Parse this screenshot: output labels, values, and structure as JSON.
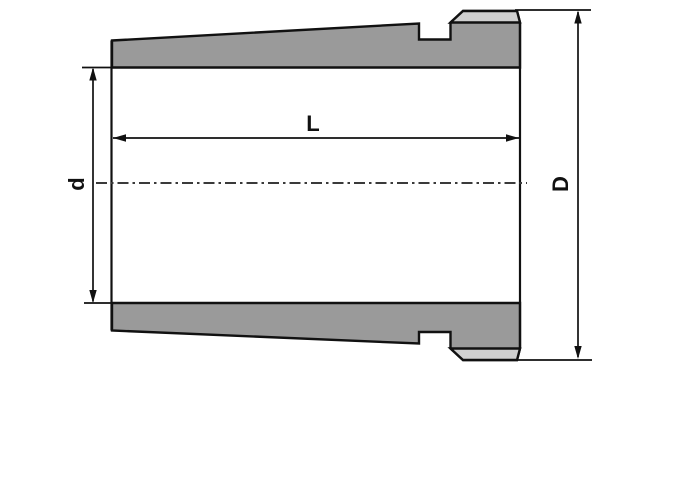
{
  "drawing": {
    "kind": "technical-section-drawing",
    "labels": {
      "length": "L",
      "bore_diameter": "d",
      "outer_diameter": "D"
    },
    "colors": {
      "body_fill": "#9a9a9a",
      "chamfer_fill": "#d0d0d0",
      "line": "#111111",
      "centerline": "#3a3a3a",
      "background": "#ffffff"
    }
  }
}
